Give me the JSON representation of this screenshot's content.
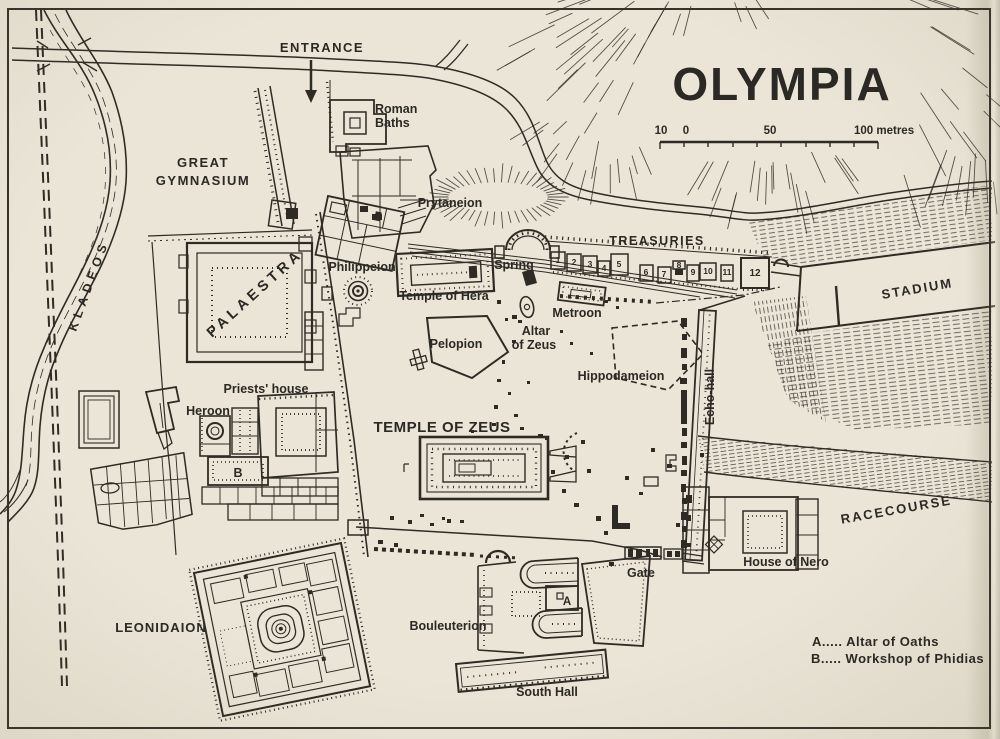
{
  "title": "OLYMPIA",
  "scale": {
    "t10": "10",
    "t0": "0",
    "t50": "50",
    "t100": "100 metres"
  },
  "labels": {
    "entrance": "ENTRANCE",
    "roman_baths_1": "Roman",
    "roman_baths_2": "Baths",
    "great_gym_1": "GREAT",
    "great_gym_2": "GYMNASIUM",
    "kladeos": "KLADEOS",
    "prytaneion": "Prytaneion",
    "philippeion": "Philippeion",
    "temple_of_hera": "Temple of Hera",
    "spring": "Spring",
    "treasuries": "TREASURIES",
    "stadium": "STADIUM",
    "metroon": "Metroon",
    "altar_1": "Altar",
    "altar_2": "of Zeus",
    "pelopion": "Pelopion",
    "hippodameion": "Hippodameion",
    "echo_hall": "Echo-hall",
    "palaestra": "PALAESTRA",
    "priests_house": "Priests' house",
    "heroon": "Heroon",
    "temple_of_zeus": "TEMPLE OF ZEUS",
    "leonidaion": "LEONIDAION",
    "bouleuterion": "Bouleuterion",
    "gate": "Gate",
    "house_of_nero": "House of Nero",
    "racecourse": "RACECOURSE",
    "south_hall": "South Hall",
    "marker_a": "A",
    "marker_b": "B"
  },
  "treasury_numbers": [
    "1",
    "2",
    "3",
    "4",
    "5",
    "6",
    "7",
    "8",
    "9",
    "10",
    "11",
    "12"
  ],
  "legend": {
    "a": "A..... Altar of Oaths",
    "b": "B..... Workshop of Phidias"
  },
  "colors": {
    "paper": "#eae5d7",
    "ink": "#2b2924"
  }
}
